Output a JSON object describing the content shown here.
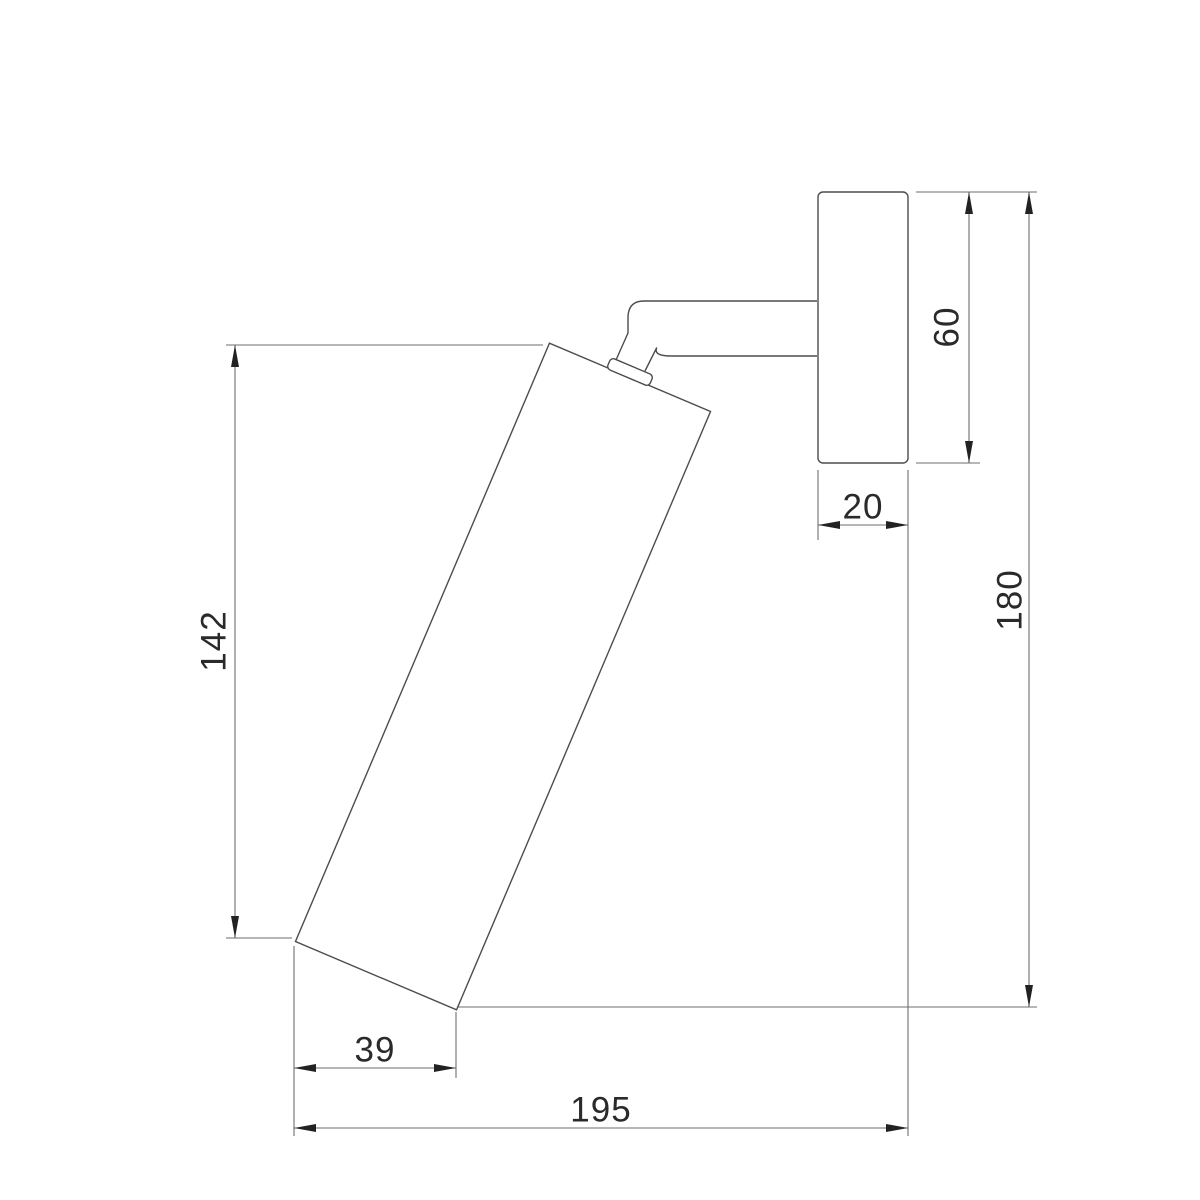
{
  "page": {
    "background_color": "#ffffff"
  },
  "drawing": {
    "description": "Side-view technical dimension drawing of a wall-mounted adjustable cylindrical spot light",
    "geometry_line_color": "#4d4d4d",
    "dimension_line_color": "#6e6e6e",
    "label_color": "#2a2a2a",
    "dimensions": {
      "lamp_height": "142",
      "base_width": "39",
      "overall_width": "195",
      "bracket_depth": "20",
      "bracket_height": "60",
      "overall_height": "180"
    }
  }
}
